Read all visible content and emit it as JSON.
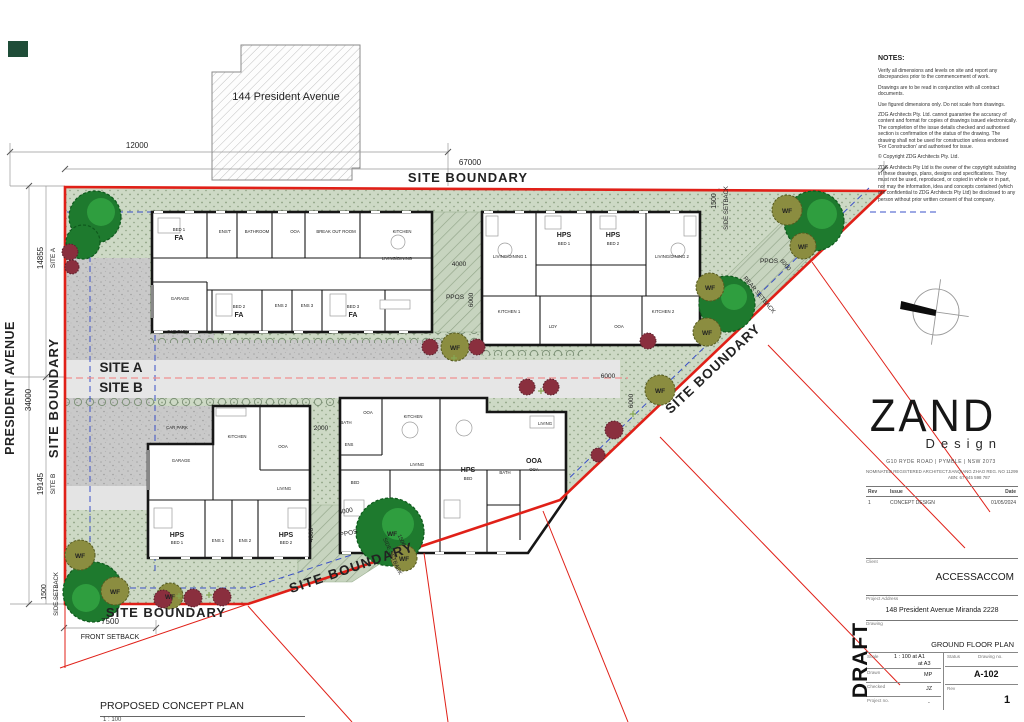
{
  "plan": {
    "neighbor_label": "144 President Avenue",
    "street": "PRESIDENT AVENUE",
    "site_boundary": "SITE BOUNDARY",
    "site_a": "SITE A",
    "site_b": "SITE B",
    "ppos": "PPOS",
    "wf": "WF",
    "front_setback": "FRONT SETBACK",
    "side_setback": "SIDE SETBACK",
    "rear_setback": "REAR SETBACK",
    "title": "PROPOSED CONCEPT PLAN",
    "title_scale": "1 : 100",
    "dims": {
      "d12000": "12000",
      "d67000": "67000",
      "d34000": "34000",
      "d14855": "14855",
      "d19145": "19145",
      "d1500": "1500",
      "d7500": "7500",
      "d4000": "4000",
      "d6000": "6000",
      "d2000": "2000"
    }
  },
  "rooms": {
    "bed1": "BED 1",
    "bed2": "BED 2",
    "bed3": "BED 3",
    "bed": "BED",
    "fa": "FA",
    "hps": "HPS",
    "ooa": "OOA",
    "kitchen": "KITCHEN",
    "kitchen1": "KITCHEN 1",
    "kitchen2": "KITCHEN 2",
    "living": "LIVING",
    "living_dining": "LIVING/DINING",
    "living_dining1": "LIVING/DINING 1",
    "living_dining2": "LIVING/DINING 2",
    "garage": "GARAGE",
    "car_park": "CAR PARK",
    "bathroom": "BATHROOM",
    "bath": "BATH",
    "ens_t": "ENS'T",
    "ens": "ENS",
    "ens1": "ENS 1",
    "ens2": "ENS 2",
    "ens3": "ENS 3",
    "ldy": "LDY",
    "break_out": "BREAK OUT ROOM"
  },
  "titleblock": {
    "notes_heading": "NOTES:",
    "notes": [
      "Verify all dimensions and levels on site and report any discrepancies prior to the commencement of work.",
      "Drawings are to be read in conjunction with all contract documents.",
      "Use figured dimensions only. Do not scale from drawings.",
      "ZDG Architects Pty. Ltd. cannot guarantee the accuracy of content and format for copies of drawings issued electronically. The completion of the issue details checked and authorised section is confirmation of the status of the drawing. The drawing shall not be used for construction unless endorsed 'For Construction' and authorised for issue.",
      "© Copyright ZDG Architects Pty. Ltd.",
      "ZDG Architects Pty Ltd is the owner of the copyright subsisting in these drawings, plans, designs and specifications. They must not be used, reproduced, or copied in whole or in part, nor may the information, idea and concepts contained (which are confidential to ZDG Architects Pty Ltd) be disclosed to any person without prior written consent of that company."
    ],
    "logo": {
      "zand": "ZAND",
      "design": "Design"
    },
    "address": "G10 RYDE ROAD   |   PYMBLE   |   NSW 2073",
    "architect": "NOMINATED REGISTERED ARCHITECT",
    "architect_details": "JIANQIANG ZHAO REG. NO 11299",
    "abn": "ABN: 67 645 598 787",
    "rev_table": {
      "headers": {
        "rev": "Rev",
        "issue": "Issue",
        "date": "Date"
      },
      "row": {
        "rev": "1",
        "issue": "CONCEPT DESIGN",
        "date": "01/05/2024"
      }
    },
    "client": {
      "label": "Client",
      "value": "ACCESSACCOM"
    },
    "project_address": {
      "label": "Project Address",
      "value": "148 President Avenue Miranda 2228"
    },
    "drawing": {
      "label": "Drawing",
      "value": "GROUND FLOOR PLAN"
    },
    "scale": {
      "label": "Scale",
      "value": "1 : 100 at A1",
      "value2": "at A3"
    },
    "status": {
      "label": "Status"
    },
    "drawing_no": {
      "label": "Drawing no.",
      "value": "A-102"
    },
    "drawn": {
      "label": "Drawn",
      "value": "MP"
    },
    "checked": {
      "label": "Checked",
      "value": "JZ"
    },
    "project_no": {
      "label": "Project no.",
      "value": "-"
    },
    "rev": {
      "label": "Rev",
      "value": "1"
    },
    "draft": "DRAFT"
  },
  "colors": {
    "boundary_red": "#e02018",
    "landscape_green": "#cdd9c5",
    "setback_blue": "#3a50c8",
    "divider_pink": "#ef8f8f"
  }
}
